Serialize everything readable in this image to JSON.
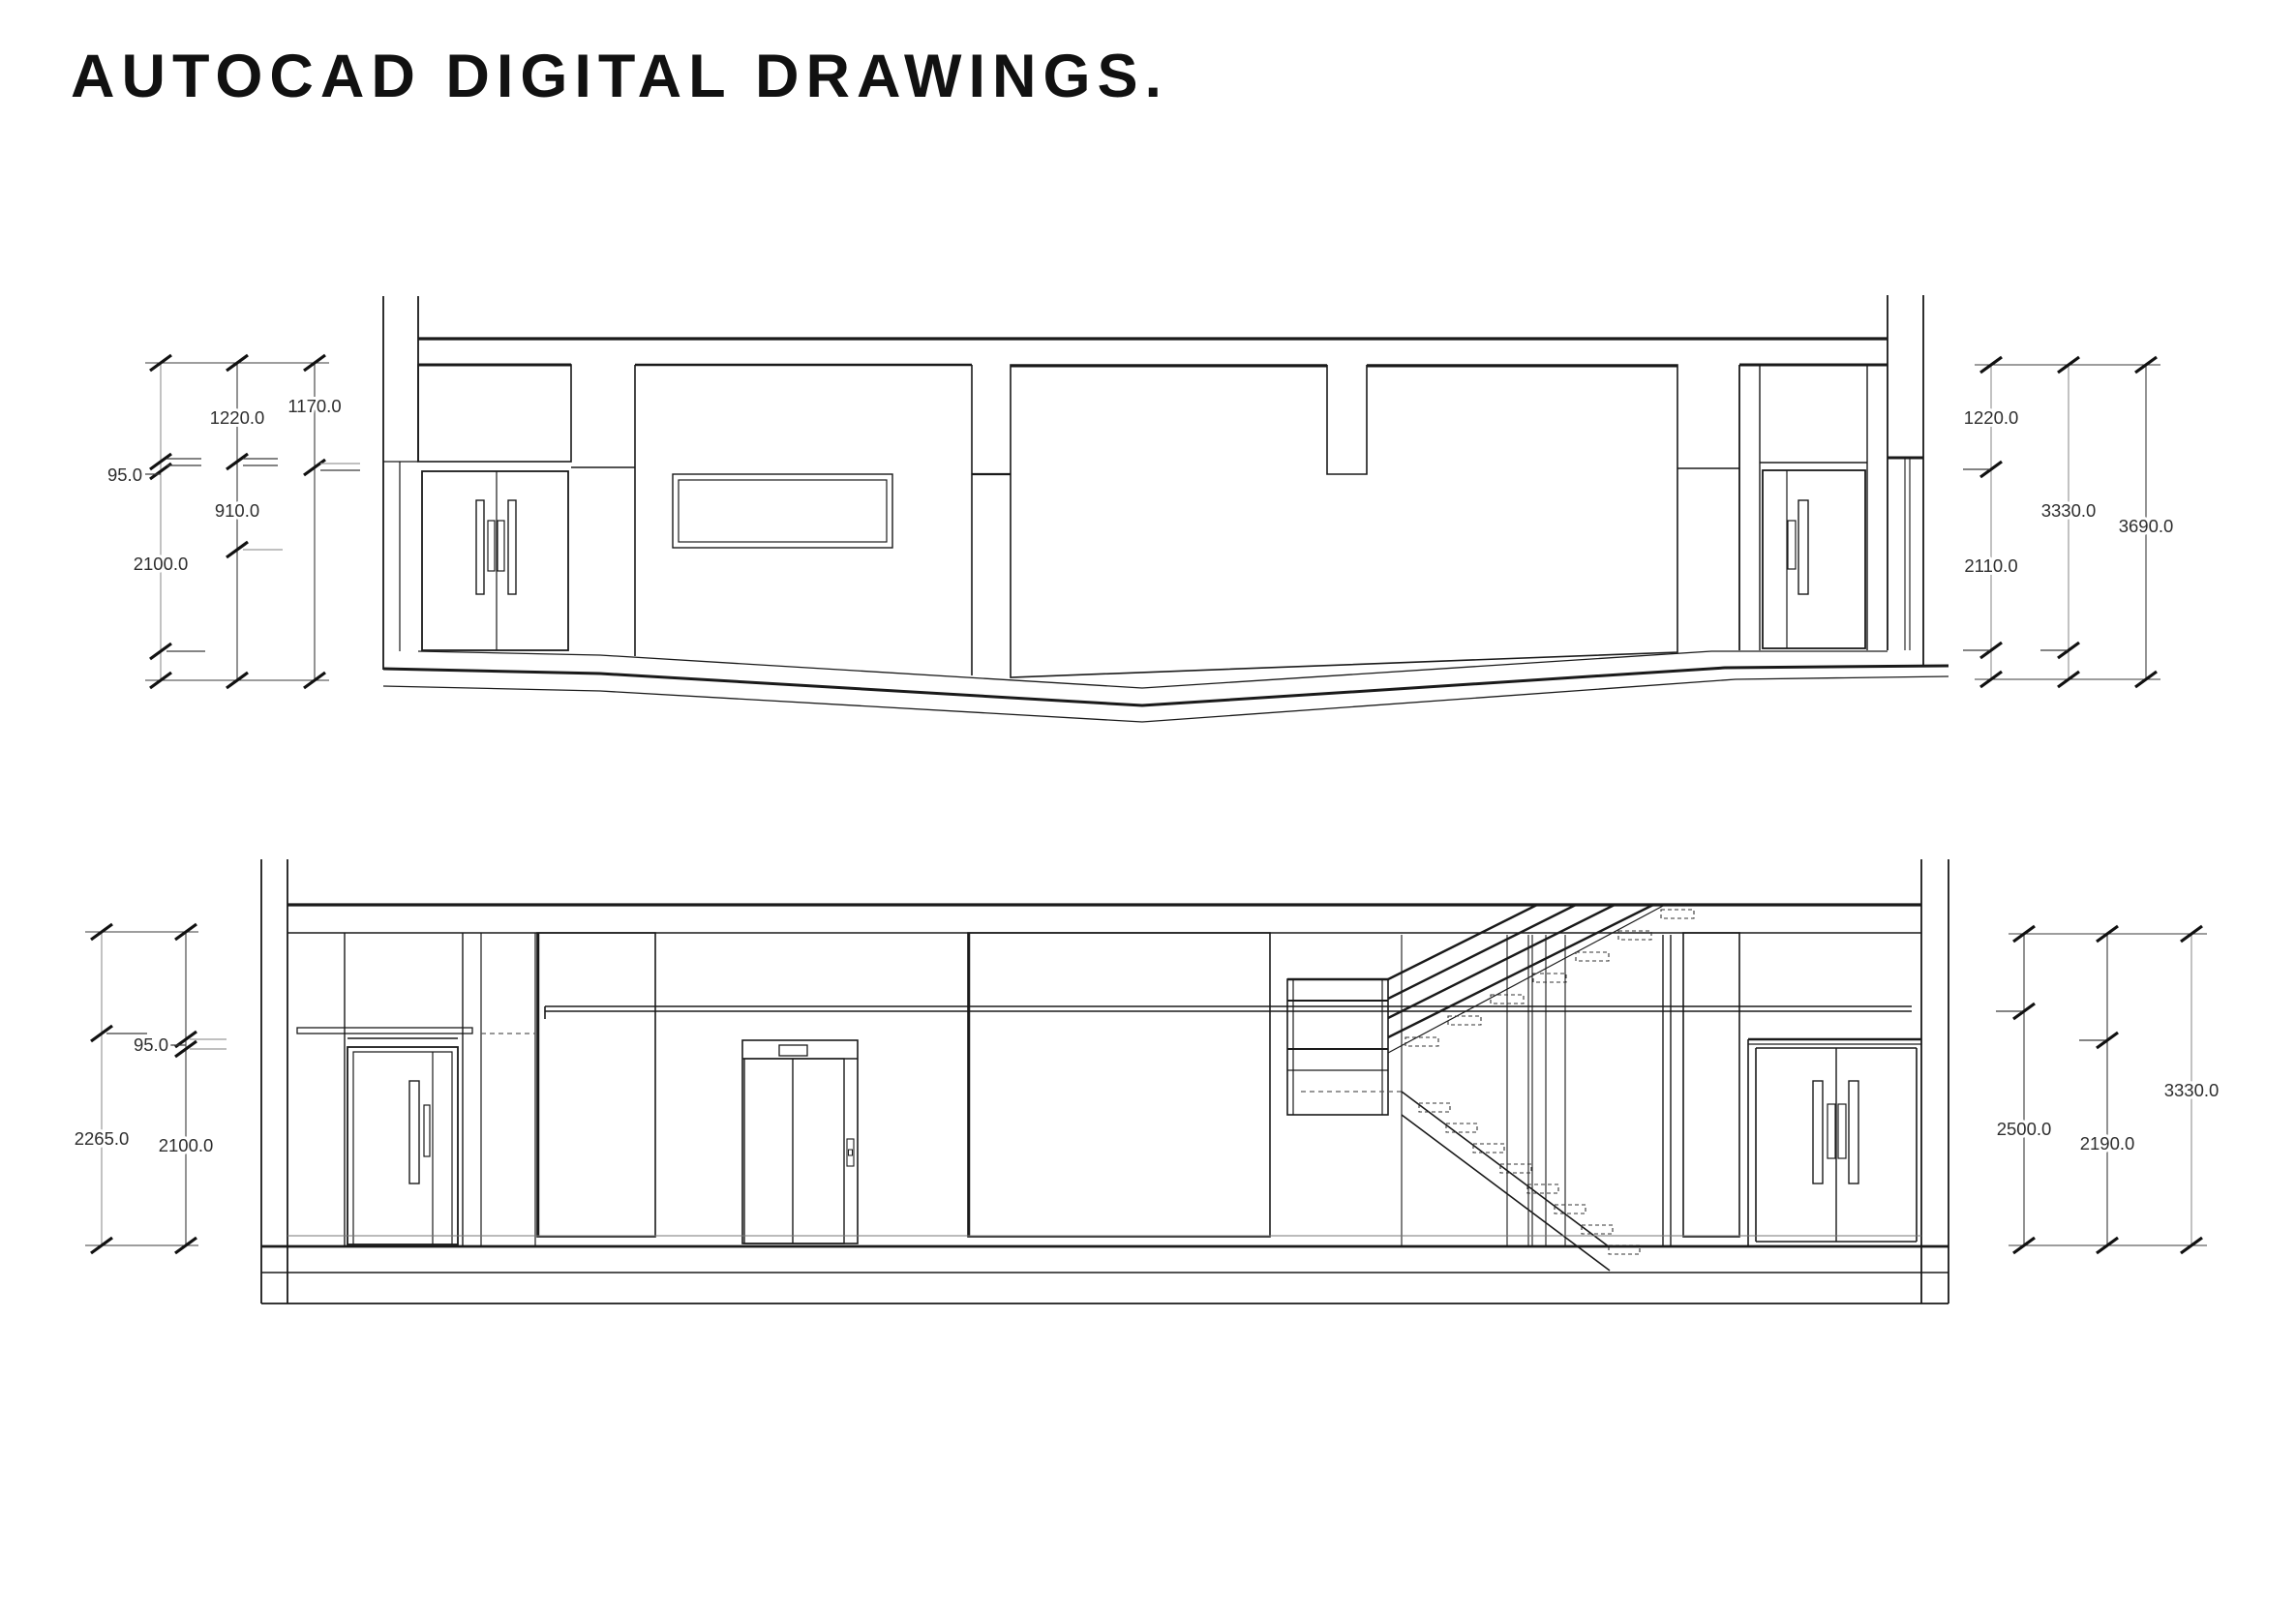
{
  "title": "AUTOCAD DIGITAL DRAWINGS.",
  "colors": {
    "background": "#ffffff",
    "line": "#1a1a1a",
    "dimension_line": "#3b3b3b",
    "dimension_text": "#2e2e2e",
    "brick_shade": "#ededed"
  },
  "top_drawing": {
    "label": "upper building section elevation",
    "dims_left": {
      "d95": "95.0",
      "d2100": "2100.0",
      "d1220": "1220.0",
      "d910": "910.0",
      "d1170": "1170.0"
    },
    "dims_right": {
      "d1220": "1220.0",
      "d2110": "2110.0",
      "d3330": "3330.0",
      "d3690": "3690.0"
    }
  },
  "bottom_drawing": {
    "label": "lower building section elevation",
    "dims_left": {
      "d95": "95.0",
      "d2265": "2265.0",
      "d2100": "2100.0"
    },
    "dims_right": {
      "d2500": "2500.0",
      "d2190": "2190.0",
      "d3330": "3330.0"
    }
  }
}
